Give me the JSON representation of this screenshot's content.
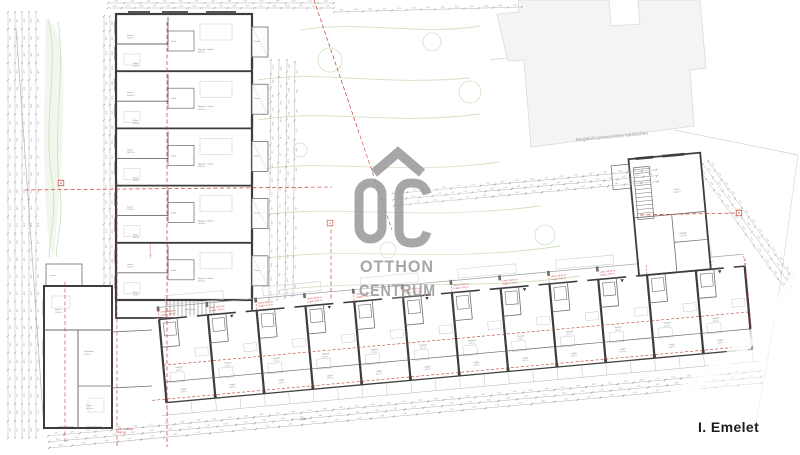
{
  "title": {
    "floor_label": "I. Emelet"
  },
  "watermark": {
    "word1": "OTTHON",
    "word2": "CENTRUM",
    "color": "#9b9b9b"
  },
  "neighbor_building": {
    "label": "Meglévő szomszédos lakóépület"
  },
  "red_note": {
    "line1": "Fal: F1 tűzfal",
    "line2": "REI 90"
  },
  "axis_label": "Lakás: 52,4 m²",
  "level_mark": "+3,03",
  "stairwell_label": "Lépcsőház",
  "section_markers": [
    {
      "letter": "B",
      "x": 61,
      "y": 183
    },
    {
      "letter": "A",
      "x": 330,
      "y": 223
    },
    {
      "letter": "D",
      "x": 739,
      "y": 213
    }
  ],
  "left_wing": {
    "units": [
      {
        "rooms": [
          {
            "name": "Szoba",
            "area": "16,24 m²"
          },
          {
            "name": "Nappali + étkező",
            "area": "25,62 m²"
          },
          {
            "name": "Fürdő",
            "area": "4,85 m²"
          },
          {
            "name": "Előtér",
            "area": "3,94 m²"
          }
        ],
        "terrace": {
          "name": "Terasz",
          "area": "5,40 m²"
        }
      },
      {
        "rooms": [
          {
            "name": "Szoba",
            "area": "15,80 m²"
          },
          {
            "name": "Nappali + étkező",
            "area": "25,48 m²"
          },
          {
            "name": "Fürdő",
            "area": "4,92 m²"
          },
          {
            "name": "Előtér",
            "area": "4,02 m²"
          }
        ],
        "terrace": {
          "name": "Terasz",
          "area": "5,40 m²"
        }
      },
      {
        "rooms": [
          {
            "name": "Szoba",
            "area": "16,02 m²"
          },
          {
            "name": "Nappali + étkező",
            "area": "25,62 m²"
          },
          {
            "name": "Fürdő",
            "area": "4,85 m²"
          },
          {
            "name": "Előtér",
            "area": "3,94 m²"
          }
        ],
        "terrace": {
          "name": "Terasz",
          "area": "5,40 m²"
        }
      },
      {
        "rooms": [
          {
            "name": "Szoba",
            "area": "15,64 m²"
          },
          {
            "name": "Nappali + étkező",
            "area": "25,48 m²"
          },
          {
            "name": "Fürdő",
            "area": "4,92 m²"
          },
          {
            "name": "Előtér",
            "area": "4,02 m²"
          }
        ],
        "terrace": {
          "name": "Terasz",
          "area": "5,40 m²"
        }
      },
      {
        "rooms": [
          {
            "name": "Szoba",
            "area": "16,24 m²"
          },
          {
            "name": "Nappali + étkező",
            "area": "25,62 m²"
          },
          {
            "name": "Fürdő",
            "area": "4,85 m²"
          },
          {
            "name": "Előtér",
            "area": "3,94 m²"
          }
        ],
        "terrace": {
          "name": "Terasz",
          "area": "5,40 m²"
        }
      }
    ]
  },
  "lower_block": {
    "rooms": [
      {
        "name": "Szoba",
        "area": "13,42 m²"
      },
      {
        "name": "Közlekedő",
        "area": "6,18 m²"
      },
      {
        "name": "Szoba",
        "area": "14,20 m²"
      }
    ],
    "terrace": {
      "name": "Terasz",
      "area": "8,25 m²"
    }
  },
  "tall_block": {
    "rooms": [
      {
        "name": "Szoba",
        "area": "14,62 m²"
      },
      {
        "name": "Nappali",
        "area": "21,35 m²"
      }
    ]
  },
  "bottom_wing": {
    "units": [
      {
        "label1": "Lakás: 36,42 m²",
        "label2": "Loggia: 4,05 m²",
        "room": "Nappali",
        "room_area": "17,2 m²",
        "loggia": "Loggia",
        "loggia_area": "4,05 m²"
      },
      {
        "label1": "Lakás: 38,54 m²",
        "label2": "Loggia: 4,05 m²",
        "room": "Nappali",
        "room_area": "17,8 m²",
        "loggia": "Loggia",
        "loggia_area": "4,05 m²"
      },
      {
        "label1": "Lakás: 36,90 m²",
        "label2": "Loggia: 4,12 m²",
        "room": "Nappali",
        "room_area": "17,2 m²",
        "loggia": "Loggia",
        "loggia_area": "4,12 m²"
      },
      {
        "label1": "Lakás: 38,54 m²",
        "label2": "Loggia: 4,05 m²",
        "room": "Nappali",
        "room_area": "17,8 m²",
        "loggia": "Loggia",
        "loggia_area": "4,05 m²"
      },
      {
        "label1": "Lakás: 36,42 m²",
        "label2": "Loggia: 4,12 m²",
        "room": "Nappali",
        "room_area": "17,2 m²",
        "loggia": "Loggia",
        "loggia_area": "4,12 m²"
      },
      {
        "label1": "Lakás: 38,76 m²",
        "label2": "Loggia: 4,05 m²",
        "room": "Nappali",
        "room_area": "18,1 m²",
        "loggia": "Loggia",
        "loggia_area": "4,05 m²"
      },
      {
        "label1": "Lakás: 36,90 m²",
        "label2": "Loggia: 4,05 m²",
        "room": "Nappali",
        "room_area": "17,2 m²",
        "loggia": "Loggia",
        "loggia_area": "4,05 m²"
      },
      {
        "label1": "Lakás: 38,54 m²",
        "label2": "Loggia: 4,12 m²",
        "room": "Nappali",
        "room_area": "17,8 m²",
        "loggia": "Loggia",
        "loggia_area": "4,12 m²"
      },
      {
        "label1": "Lakás: 36,42 m²",
        "label2": "Loggia: 4,05 m²",
        "room": "Nappali",
        "room_area": "17,2 m²",
        "loggia": "Loggia",
        "loggia_area": "4,05 m²"
      },
      {
        "label1": "Lakás: 38,76 m²",
        "label2": "Loggia: 4,05 m²",
        "room": "Nappali",
        "room_area": "18,1 m²",
        "loggia": "Loggia",
        "loggia_area": "4,05 m²"
      },
      {
        "label1": "Lakás: 36,90 m²",
        "label2": "Loggia: 4,12 m²",
        "room": "Nappali",
        "room_area": "17,2 m²",
        "loggia": "Loggia",
        "loggia_area": "4,12 m²"
      },
      {
        "label1": "Lakás: 41,25 m²",
        "label2": "Loggia: 4,36 m²",
        "room": "Nappali",
        "room_area": "19,4 m²",
        "loggia": "Loggia",
        "loggia_area": "4,36 m²"
      }
    ]
  },
  "dimensions": {
    "numbers": [
      "4,50",
      "1,35",
      "3,62",
      "0,90",
      "2,45",
      "1,20",
      "5,05",
      "0,45",
      "3,10",
      "1,65",
      "2,38",
      "0,75",
      "1,00",
      "3,85",
      "0,30",
      "2,10"
    ]
  },
  "colors": {
    "wall": "#3d3d3d",
    "partition": "#6b6b6b",
    "thin": "#9a9a9a",
    "dim_line": "#b2b2b2",
    "dim_tick": "#787878",
    "dim_text": "#8a8a8a",
    "red": "#c4392f",
    "green_stroke": "#cfe2c2",
    "green_fill": "#f1f7ed",
    "neighbor_fill": "#f4f4f4",
    "neighbor_stroke": "#dadada",
    "label": "#7c7c7c",
    "furniture": "#c9c9c9",
    "watermark": "#9b9b9b"
  }
}
